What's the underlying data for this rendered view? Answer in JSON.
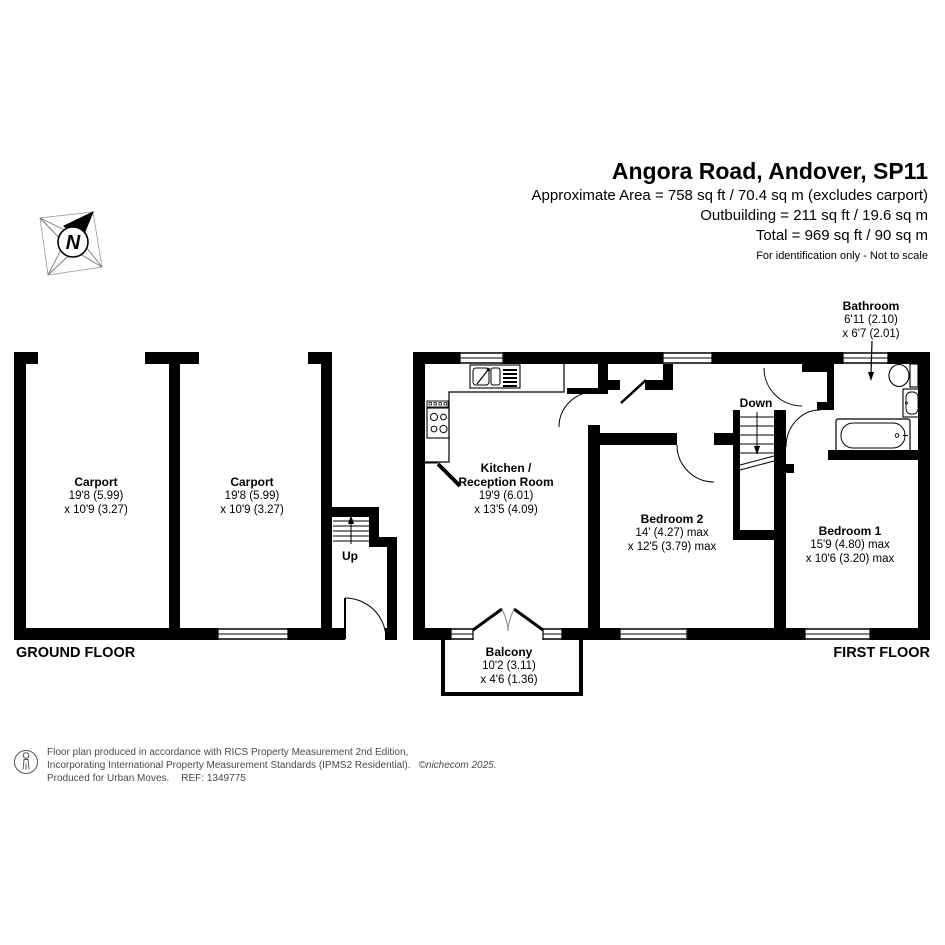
{
  "header": {
    "title": "Angora Road, Andover, SP11",
    "area_line": "Approximate Area = 758 sq ft / 70.4 sq m (excludes carport)",
    "outbuilding_line": "Outbuilding = 211 sq ft / 19.6 sq m",
    "total_line": "Total = 969 sq ft / 90 sq m",
    "disclaimer": "For identification only - Not to scale"
  },
  "compass": {
    "north_label": "N"
  },
  "floors": {
    "ground": "GROUND FLOOR",
    "first": "FIRST FLOOR"
  },
  "rooms": {
    "carport1": {
      "name": "Carport",
      "dims1": "19'8 (5.99)",
      "dims2": "x 10'9 (3.27)"
    },
    "carport2": {
      "name": "Carport",
      "dims1": "19'8 (5.99)",
      "dims2": "x 10'9 (3.27)"
    },
    "kitchen": {
      "name_line1": "Kitchen /",
      "name_line2": "Reception Room",
      "dims1": "19'9 (6.01)",
      "dims2": "x 13'5 (4.09)"
    },
    "bedroom2": {
      "name": "Bedroom 2",
      "dims1": "14' (4.27) max",
      "dims2": "x 12'5 (3.79) max"
    },
    "bedroom1": {
      "name": "Bedroom 1",
      "dims1": "15'9 (4.80) max",
      "dims2": "x 10'6 (3.20) max"
    },
    "bathroom": {
      "name": "Bathroom",
      "dims1": "6'11 (2.10)",
      "dims2": "x 6'7 (2.01)"
    },
    "balcony": {
      "name": "Balcony",
      "dims1": "10'2 (3.11)",
      "dims2": "x 4'6 (1.36)"
    }
  },
  "stairs": {
    "up": "Up",
    "down": "Down"
  },
  "footer": {
    "line1": "Floor plan produced in accordance with RICS Property Measurement 2nd Edition,",
    "line2": "Incorporating International Property Measurement Standards (IPMS2 Residential).",
    "copyright": "©nichecom 2025.",
    "produced": "Produced for Urban Moves.",
    "ref": "REF: 1349775"
  },
  "colors": {
    "wall": "#000000",
    "text": "#000000",
    "footer_text": "#4a4a4a"
  }
}
